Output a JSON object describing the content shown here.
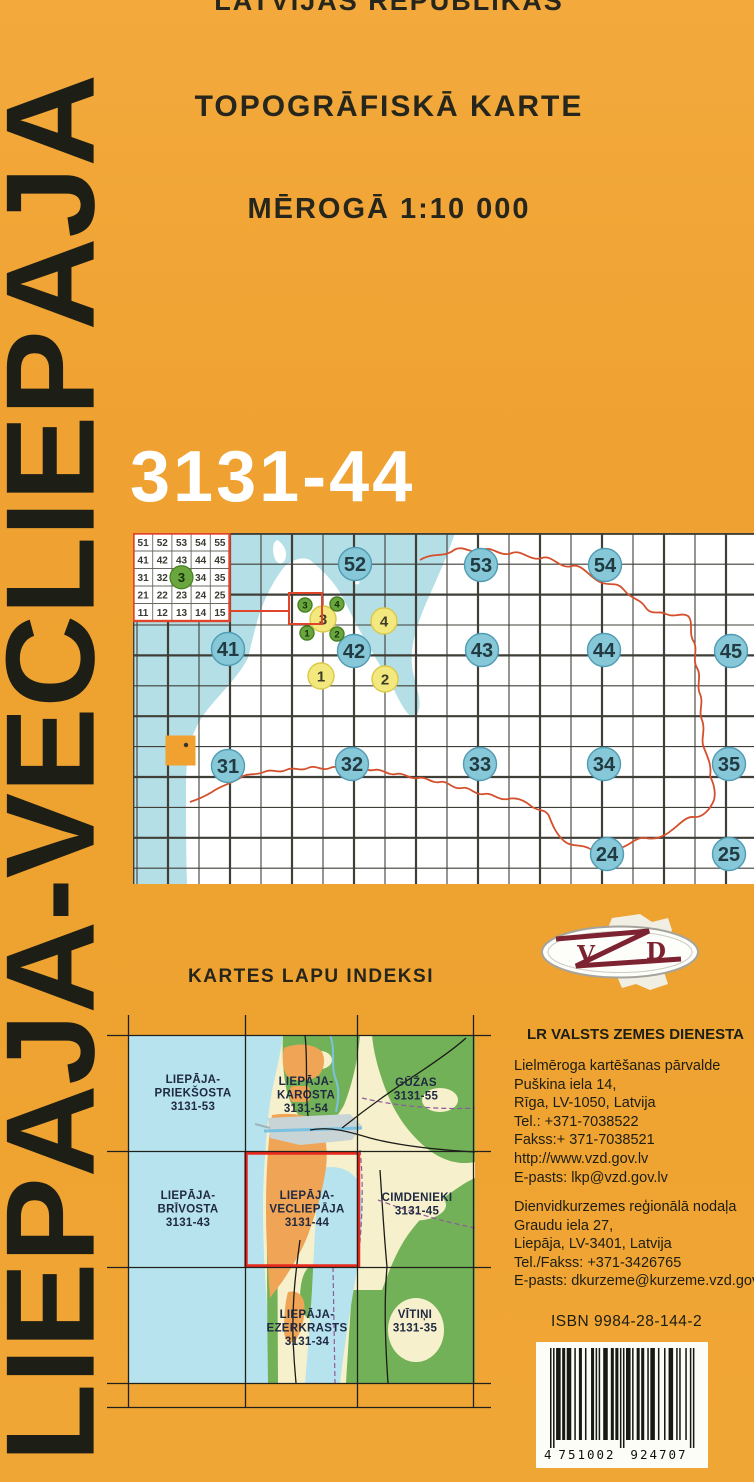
{
  "cover": {
    "country_line": "LATVIJAS REPUBLIKAS",
    "type_line": "TOPOGRĀFISKĀ KARTE",
    "scale_line": "MĒROGĀ 1:10 000",
    "vertical_title": "LIEPĀJA-VECLIEPĀJA",
    "sheet_number": "3131-44"
  },
  "map_index": {
    "inset_rows": [
      [
        "51",
        "52",
        "53",
        "54",
        "55"
      ],
      [
        "41",
        "42",
        "43",
        "44",
        "45"
      ],
      [
        "31",
        "32",
        "33",
        "34",
        "35"
      ],
      [
        "21",
        "22",
        "23",
        "24",
        "25"
      ],
      [
        "11",
        "12",
        "13",
        "14",
        "15"
      ]
    ],
    "inset_highlight": {
      "row": 2,
      "col": 2,
      "label": "3"
    },
    "blue_circles": [
      {
        "label": "52",
        "x": 355,
        "y": 564
      },
      {
        "label": "53",
        "x": 481,
        "y": 565
      },
      {
        "label": "54",
        "x": 605,
        "y": 565
      },
      {
        "label": "41",
        "x": 228,
        "y": 649
      },
      {
        "label": "42",
        "x": 354,
        "y": 651
      },
      {
        "label": "43",
        "x": 482,
        "y": 650
      },
      {
        "label": "44",
        "x": 604,
        "y": 650
      },
      {
        "label": "45",
        "x": 731,
        "y": 651
      },
      {
        "label": "31",
        "x": 228,
        "y": 766
      },
      {
        "label": "32",
        "x": 352,
        "y": 764
      },
      {
        "label": "33",
        "x": 480,
        "y": 764
      },
      {
        "label": "34",
        "x": 604,
        "y": 764
      },
      {
        "label": "35",
        "x": 729,
        "y": 764
      },
      {
        "label": "24",
        "x": 607,
        "y": 854
      },
      {
        "label": "25",
        "x": 729,
        "y": 854
      }
    ],
    "yellow_circles": [
      {
        "label": "3",
        "x": 323,
        "y": 619
      },
      {
        "label": "4",
        "x": 384,
        "y": 621
      },
      {
        "label": "1",
        "x": 321,
        "y": 676
      },
      {
        "label": "2",
        "x": 385,
        "y": 679
      }
    ],
    "green_circles": [
      {
        "label": "3",
        "x": 305,
        "y": 605
      },
      {
        "label": "4",
        "x": 337,
        "y": 604
      },
      {
        "label": "1",
        "x": 307,
        "y": 633
      },
      {
        "label": "2",
        "x": 337,
        "y": 634
      }
    ],
    "colors": {
      "sea": "#b5dfe6",
      "land": "#ffffff",
      "grid": "#3f3f38",
      "country_border": "#d4502c",
      "blue_fill": "#86c8d8",
      "blue_stroke": "#4f9cb4",
      "yellow_fill": "#f2e87d",
      "yellow_stroke": "#d9c84a",
      "green_fill": "#6aa63e",
      "green_stroke": "#44801f",
      "marker": "#f0a12f",
      "inset_red": "#e0452a"
    }
  },
  "sheet_index": {
    "heading": "KARTES LAPU INDEKSI",
    "labels": [
      {
        "x": 193,
        "y": 1083,
        "lines": [
          "LIEPĀJA-",
          "PRIEKŠOSTA",
          "3131-53"
        ]
      },
      {
        "x": 306,
        "y": 1085,
        "lines": [
          "LIEPĀJA-",
          "KAROSTA",
          "3131-54"
        ]
      },
      {
        "x": 416,
        "y": 1086,
        "lines": [
          "GŪŽAS",
          "3131-55"
        ]
      },
      {
        "x": 188,
        "y": 1199,
        "lines": [
          "LIEPĀJA-",
          "BRĪVOSTA",
          "3131-43"
        ]
      },
      {
        "x": 307,
        "y": 1199,
        "lines": [
          "LIEPĀJA-",
          "VECLIEPĀJA",
          "3131-44"
        ]
      },
      {
        "x": 417,
        "y": 1201,
        "lines": [
          "CIMDENIEKI",
          "3131-45"
        ]
      },
      {
        "x": 307,
        "y": 1318,
        "lines": [
          "LIEPĀJA-",
          "EZERKRASTS",
          "3131-34"
        ]
      },
      {
        "x": 415,
        "y": 1318,
        "lines": [
          "VĪTIŅI",
          "3131-35"
        ]
      }
    ],
    "map_colors": {
      "sea": "#b7e3ef",
      "fields": "#f6f1cc",
      "forest": "#73b158",
      "city": "#f0a455",
      "port": "#c9d4d7",
      "highlight": "#e8291e",
      "road": "#1b1b18"
    }
  },
  "publisher": {
    "heading": "LR VALSTS ZEMES DIENESTA",
    "office1": [
      "Lielmēroga kartēšanas pārvalde",
      "Puškina iela 14,",
      "Rīga, LV-1050, Latvija",
      "Tel.: +371-7038522",
      "Fakss:+ 371-7038521",
      "http://www.vzd.gov.lv",
      "E-pasts: lkp@vzd.gov.lv"
    ],
    "office2": [
      "Dienvidkurzemes reģionālā nodaļa",
      "Graudu iela 27,",
      "Liepāja, LV-3401, Latvija",
      "Tel./Fakss: +371-3426765",
      "E-pasts: dkurzeme@kurzeme.vzd.gov.lv"
    ],
    "logo_letters": {
      "v": "V",
      "z": "Z",
      "d": "D"
    },
    "logo_color": "#7d2230"
  },
  "isbn": "ISBN 9984-28-144-2",
  "barcode": {
    "digits": "4751002924707",
    "groups": [
      "4",
      "751002",
      "924707"
    ]
  }
}
